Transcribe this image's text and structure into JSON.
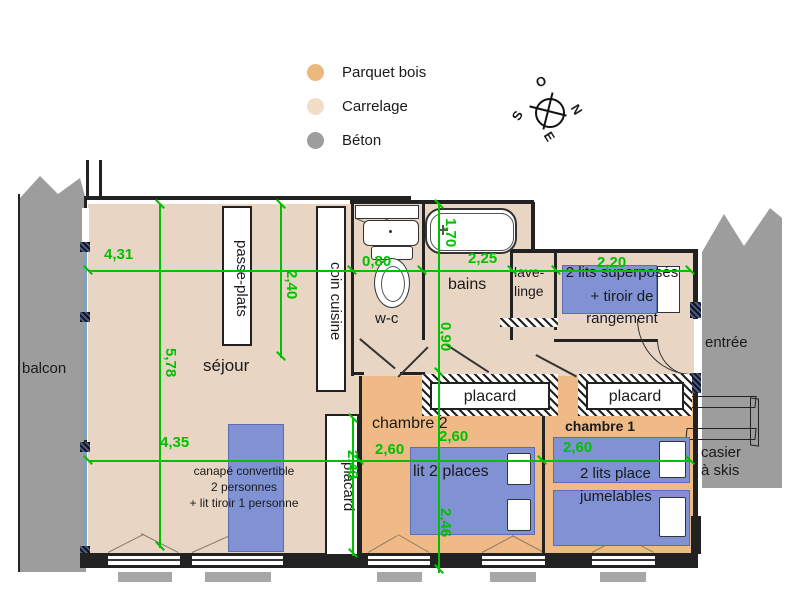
{
  "legend": {
    "items": [
      {
        "label": "Parquet bois",
        "color": "#edb87e"
      },
      {
        "label": "Carrelage",
        "color": "#f3ddc9"
      },
      {
        "label": "Béton",
        "color": "#9d9d9d"
      }
    ]
  },
  "compass": {
    "o": "O",
    "n": "N",
    "s": "S",
    "e": "E"
  },
  "rooms": {
    "balcon": "balcon",
    "sejour": "séjour",
    "passe_plats": "passe-plats",
    "coin_cuisine": "coin cuisine",
    "wc": "w-c",
    "bains": "bains",
    "lave_linge_l1": "lave-",
    "lave_linge_l2": "linge",
    "placard_sejour": "placard",
    "placard_ch2": "placard",
    "placard_ch1": "placard",
    "chambre2": "chambre 2",
    "chambre1": "chambre 1",
    "entree": "entrée",
    "casier_l1": "casier",
    "casier_l2": "à skis"
  },
  "furniture": {
    "bunk_l1": "2 lits superposés",
    "bunk_l2": "+ tiroir de",
    "bunk_l3": "rangement",
    "sofa_l1": "canapé convertible",
    "sofa_l2": "2 personnes",
    "sofa_l3": "+ lit tiroir 1 personne",
    "double_bed": "lit 2 places",
    "twin_l1": "2 lits place",
    "twin_l2": "jumelables"
  },
  "dimensions": {
    "h431": "4,31",
    "h080": "0,80",
    "h225": "2,25",
    "h220": "2,20",
    "h435": "4,35",
    "h260_ch2_left": "2,60",
    "h260_ch2": "2,60",
    "h260_ch1": "2,60",
    "v578": "5,78",
    "v240": "2,40",
    "v170": "1,70",
    "v090": "0,90",
    "v246": "2,46",
    "v243": "2,43"
  },
  "colors": {
    "parquet": "#f0ba86",
    "carrelage": "#e9d5c3",
    "beton": "#9d9d9d",
    "bed_blue": "#8092d4",
    "dimension_green": "#00c000",
    "wall": "#222222"
  }
}
